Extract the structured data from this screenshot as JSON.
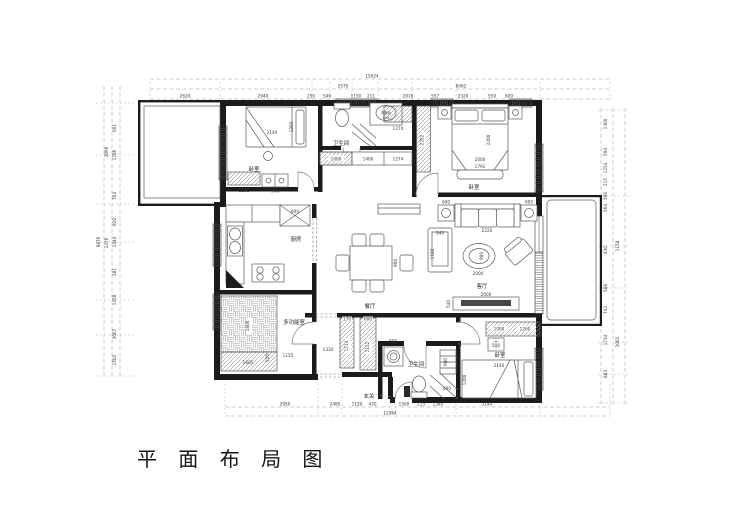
{
  "title": "平 面 布 局 图",
  "colors": {
    "ink": "#1b1b1b",
    "paper": "#ffffff"
  },
  "rooms": {
    "bedroom_top_left": "卧室",
    "bathroom_top": "卫生间",
    "washbasin": "洗漱台",
    "bedroom_master": "卧室",
    "kitchen": "厨房",
    "dining": "餐厅",
    "living": "客厅",
    "multi_room": "多功能室",
    "bathroom_bottom": "卫生间",
    "bedroom_bottom": "卧室",
    "entry": "玄关"
  },
  "dims": {
    "top": [
      "15024",
      "2570",
      "6062",
      "2620",
      "2940",
      "250",
      "546",
      "1150",
      "211",
      "2016",
      "557",
      "2320",
      "559",
      "609"
    ],
    "bottom": [
      "12064",
      "2950",
      "2480",
      "1150",
      "430",
      "1560",
      "215",
      "1340",
      "3140"
    ],
    "left": [
      "9876",
      "3066",
      "2476",
      "601",
      "1786",
      "764",
      "920",
      "1444",
      "281",
      "1458",
      "3067",
      "1502"
    ],
    "right": [
      "1158",
      "3065",
      "1300",
      "594",
      "1254",
      "215",
      "596",
      "564",
      "430",
      "588",
      "742",
      "1734",
      "883"
    ],
    "inner": {
      "bed1_w": "2140",
      "bed1_d": "1350",
      "wardrobe1": "1161",
      "cabinet1": "900",
      "hall_cab_a": "1000",
      "hall_cab_b": "1400",
      "hall_cab_c": "1274",
      "hall_cab_d": "1274",
      "washbasin_w": "600",
      "master_wardrobe": "2262",
      "master_bed_w": "2000",
      "master_bed_l": "2200",
      "bench": "1791",
      "nightstand_l": "600",
      "nightstand_r": "600",
      "side_table_l": "600",
      "side_table_r": "600",
      "sofa": "2220",
      "chaise_w": "940",
      "chaise_d": "1180",
      "coffee_table": "900",
      "living_w": "2000",
      "tv_w": "2000",
      "tv_d": "540",
      "fridge": "600",
      "dining_table": "900",
      "tatami": "1800",
      "platform_a": "1605",
      "platform_b": "550",
      "platform_c": "1155",
      "closet1_w": "170",
      "closet1_d": "1714",
      "closet2_w": "600",
      "closet2_d": "1152",
      "corridor": "1334",
      "washer": "600",
      "bath_cab": "600",
      "shower": "400",
      "wardrobe3_a": "1000",
      "wardrobe3_b": "1260",
      "nightstand3": "500",
      "bed3_w": "2140",
      "bed3_d": "1200"
    }
  }
}
